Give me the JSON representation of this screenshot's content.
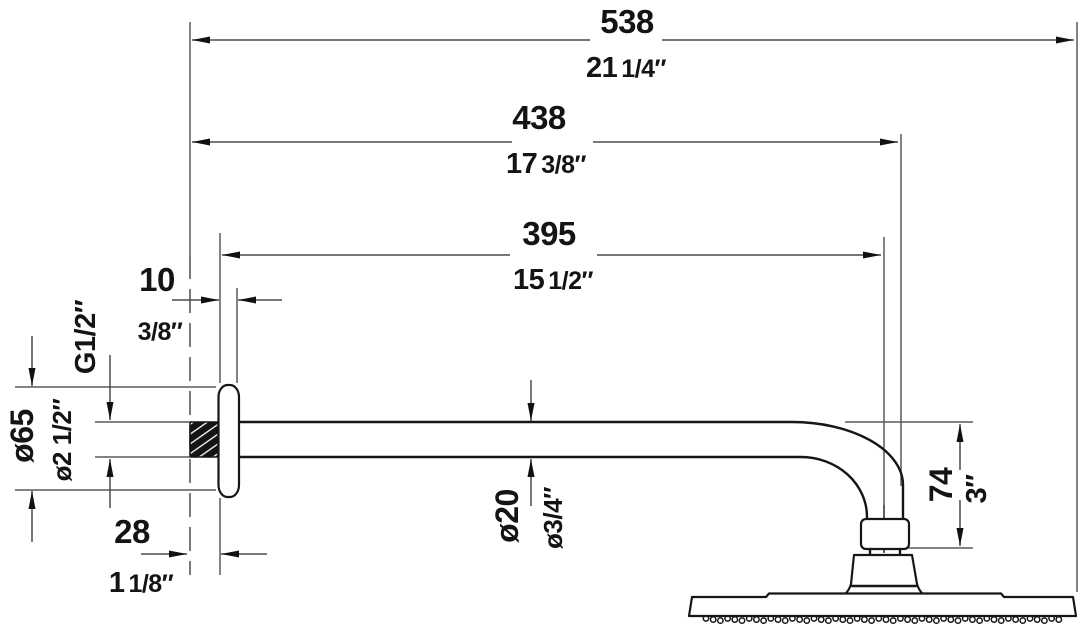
{
  "dims": {
    "d538": {
      "mm": "538",
      "inch_whole": "21",
      "inch_frac": "1/4″"
    },
    "d438": {
      "mm": "438",
      "inch_whole": "17",
      "inch_frac": "3/8″"
    },
    "d395": {
      "mm": "395",
      "inch_whole": "15",
      "inch_frac": "1/2″"
    },
    "d10": {
      "mm": "10",
      "inch_frac": "3/8″"
    },
    "d28": {
      "mm": "28",
      "inch_whole": "1",
      "inch_frac": "1/8″"
    },
    "thread": {
      "label": "G1/2″"
    },
    "d65": {
      "mm": "ø65",
      "inch": "ø2 1/2″"
    },
    "d20": {
      "mm": "ø20",
      "inch": "ø3/4″"
    },
    "d74": {
      "mm": "74",
      "inch": "3″"
    }
  },
  "colors": {
    "object_line": "#161616",
    "dimension_line": "#4a4a4a",
    "extension_line": "#5a5a5a",
    "background": "#ffffff"
  }
}
